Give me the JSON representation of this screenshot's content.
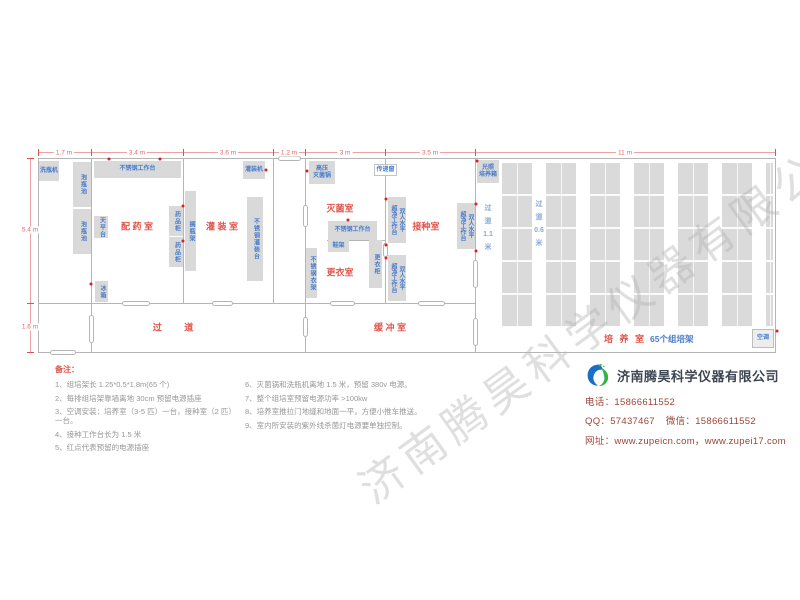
{
  "watermark": "济南腾昊科学仪器有限公司",
  "plan": {
    "rooms": [
      {
        "name": "prep-room",
        "label": "配 药 室",
        "x": 137,
        "y": 226
      },
      {
        "name": "filling-room",
        "label": "灌 装 室",
        "x": 222,
        "y": 226
      },
      {
        "name": "sterilization-room",
        "label": "灭菌室",
        "x": 340,
        "y": 208
      },
      {
        "name": "dressing-room",
        "label": "更衣室",
        "x": 340,
        "y": 272
      },
      {
        "name": "inoculation-room",
        "label": "接种室",
        "x": 426,
        "y": 226
      },
      {
        "name": "corridor",
        "label": "过    道",
        "x": 178,
        "y": 327,
        "ls": 10
      },
      {
        "name": "buffer-room",
        "label": "缓 冲 室",
        "x": 390,
        "y": 327
      }
    ],
    "culture_room": {
      "red_label": "培 养 室",
      "blue_label": "65个组培架"
    },
    "aisles": [
      {
        "name": "aisle-1-1m",
        "lines": [
          "过",
          "道",
          "1.1",
          "米"
        ],
        "x": 488,
        "y": 228
      },
      {
        "name": "aisle-0-6m",
        "lines": [
          "过",
          "道",
          "0.6",
          "米"
        ],
        "x": 539,
        "y": 224
      }
    ],
    "equipment": [
      {
        "name": "bottle-washer",
        "label": "洗瓶机",
        "x": 39,
        "y": 161,
        "w": 20,
        "h": 20,
        "mode": "h"
      },
      {
        "name": "soak-pool-1",
        "label": "泡瓶池",
        "x": 73,
        "y": 162,
        "w": 18,
        "h": 45,
        "mode": "v"
      },
      {
        "name": "soak-pool-2",
        "label": "泡瓶池",
        "x": 73,
        "y": 209,
        "w": 18,
        "h": 45,
        "mode": "v"
      },
      {
        "name": "ss-workbench-prep",
        "label": "不锈钢工作台",
        "x": 94,
        "y": 161,
        "w": 87,
        "h": 17,
        "mode": "h"
      },
      {
        "name": "balance-table",
        "label": "天平台",
        "x": 94,
        "y": 216,
        "w": 14,
        "h": 22,
        "mode": "v"
      },
      {
        "name": "medicine-cabinet-1",
        "label": "药品柜",
        "x": 169,
        "y": 206,
        "w": 14,
        "h": 30,
        "mode": "v"
      },
      {
        "name": "medicine-cabinet-2",
        "label": "药品柜",
        "x": 169,
        "y": 237,
        "w": 14,
        "h": 30,
        "mode": "v"
      },
      {
        "name": "bottle-shelf-rack",
        "label": "搁瓶架",
        "x": 185,
        "y": 191,
        "w": 11,
        "h": 80,
        "mode": "v"
      },
      {
        "name": "fridge",
        "label": "冰箱",
        "x": 95,
        "y": 281,
        "w": 13,
        "h": 21,
        "mode": "v"
      },
      {
        "name": "filling-machine",
        "label": "灌装机",
        "x": 243,
        "y": 161,
        "w": 22,
        "h": 18,
        "mode": "h"
      },
      {
        "name": "ss-filling-table",
        "label": "不锈钢灌装台",
        "x": 247,
        "y": 197,
        "w": 16,
        "h": 84,
        "mode": "v"
      },
      {
        "name": "autoclave",
        "label": "高压\n灭菌锅",
        "x": 309,
        "y": 161,
        "w": 26,
        "h": 23,
        "mode": "h"
      },
      {
        "name": "pass-through-window",
        "label": "传递窗",
        "x": 374,
        "y": 164,
        "w": 23,
        "h": 12,
        "mode": "h",
        "light": true
      },
      {
        "name": "ss-workbench-steril",
        "label": "不锈钢工作台",
        "x": 328,
        "y": 221,
        "w": 49,
        "h": 19,
        "mode": "h"
      },
      {
        "name": "shoe-rack",
        "label": "鞋架",
        "x": 328,
        "y": 240,
        "w": 21,
        "h": 12,
        "mode": "h"
      },
      {
        "name": "locker",
        "label": "更衣柜",
        "x": 369,
        "y": 240,
        "w": 13,
        "h": 48,
        "mode": "v"
      },
      {
        "name": "ss-clothes-rack",
        "label": "不锈钢衣架",
        "x": 306,
        "y": 248,
        "w": 11,
        "h": 50,
        "mode": "v"
      },
      {
        "name": "clean-bench-1",
        "label": "双人水平\n超净工作台",
        "x": 388,
        "y": 197,
        "w": 18,
        "h": 46,
        "mode": "v2"
      },
      {
        "name": "clean-bench-2",
        "label": "双人水平\n超净工作台",
        "x": 388,
        "y": 255,
        "w": 18,
        "h": 46,
        "mode": "v2"
      },
      {
        "name": "clean-bench-3",
        "label": "双人水平\n超净工作台",
        "x": 457,
        "y": 203,
        "w": 18,
        "h": 46,
        "mode": "v2"
      },
      {
        "name": "light-incubator",
        "label": "光照\n培养箱",
        "x": 477,
        "y": 160,
        "w": 22,
        "h": 23,
        "mode": "h"
      },
      {
        "name": "air-conditioner",
        "label": "空调",
        "x": 752,
        "y": 329,
        "w": 22,
        "h": 19,
        "mode": "h",
        "light2": true
      }
    ],
    "dimensions": {
      "top": [
        {
          "label": "1.7 m",
          "cx": 64
        },
        {
          "label": "3.4 m",
          "cx": 137
        },
        {
          "label": "3.6 m",
          "cx": 228
        },
        {
          "label": "1.2 m",
          "cx": 289
        },
        {
          "label": "3 m",
          "cx": 345
        },
        {
          "label": "3.5 m",
          "cx": 430
        },
        {
          "label": "11 m",
          "cx": 625
        }
      ],
      "left": [
        {
          "label": "5.4 m",
          "cy": 230
        },
        {
          "label": "1.6 m",
          "cy": 327
        }
      ]
    }
  },
  "notes": {
    "title": "备注：",
    "col1": [
      "1、组培架长 1.25*0.5*1.8m(65 个)",
      "2、每排组培架靠墙离地 30cm 预留电源插座",
      "3、空调安装：培养室（3-5 匹）一台，接种室（2 匹）一台。",
      "4、接种工作台长为 1.5 米",
      "5、红点代表预留的电源插座"
    ],
    "col2": [
      "6、灭菌锅和洗瓶机离地 1.5 米，预留 380v 电源。",
      "7、整个组培室预留电源功率 >100kw",
      "8、培养室推拉门地缝和地面一平，方便小推车推送。",
      "9、室内所安装的紫外线杀菌灯电源要单独控制。"
    ]
  },
  "company": {
    "name": "济南腾昊科学仪器有限公司",
    "phone_label": "电话：",
    "phone": "15866611552",
    "qq_label": "QQ：",
    "qq": "57437467",
    "wechat_label": "微信：",
    "wechat": "15866611552",
    "web_label": "网址：",
    "web": "www.zupeicn.com，www.zupei17.com"
  },
  "colors": {
    "accent_red": "#e0544a",
    "label_blue": "#4a7cc9",
    "corridor_blue": "#85a9da",
    "block_grey": "#d9d9d9",
    "wall_grey": "#b5b5b5",
    "dim_pink": "#eda3a3",
    "note_grey": "#979797",
    "company_text": "#9c4538"
  },
  "layout": {
    "walls": [
      [
        38,
        158,
        737,
        1
      ],
      [
        38,
        352,
        738,
        1
      ],
      [
        38,
        158,
        1,
        195
      ],
      [
        775,
        158,
        1,
        195
      ],
      [
        91,
        158,
        1,
        145
      ],
      [
        91,
        303,
        1,
        49
      ],
      [
        183,
        158,
        1,
        145
      ],
      [
        273,
        158,
        1,
        145
      ],
      [
        305,
        158,
        1,
        194
      ],
      [
        385,
        158,
        1,
        145
      ],
      [
        475,
        158,
        1,
        194
      ],
      [
        38,
        303,
        438,
        1
      ],
      [
        327,
        240,
        59,
        1
      ]
    ],
    "doors": [
      {
        "o": "h",
        "x": 278,
        "y": 158,
        "len": 23
      },
      {
        "o": "h",
        "x": 122,
        "y": 303,
        "len": 28
      },
      {
        "o": "h",
        "x": 212,
        "y": 303,
        "len": 21
      },
      {
        "o": "h",
        "x": 330,
        "y": 303,
        "len": 25
      },
      {
        "o": "h",
        "x": 418,
        "y": 303,
        "len": 27
      },
      {
        "o": "h",
        "x": 50,
        "y": 352,
        "len": 26
      },
      {
        "o": "v",
        "x": 91,
        "y": 315,
        "len": 28
      },
      {
        "o": "v",
        "x": 305,
        "y": 205,
        "len": 22
      },
      {
        "o": "v",
        "x": 305,
        "y": 317,
        "len": 20
      },
      {
        "o": "v",
        "x": 385,
        "y": 243,
        "len": 14
      },
      {
        "o": "v",
        "x": 475,
        "y": 260,
        "len": 28
      },
      {
        "o": "v",
        "x": 475,
        "y": 318,
        "len": 28
      }
    ],
    "racks": {
      "x_start": 502,
      "spacing": 44,
      "width": 30,
      "count": 7,
      "y": 163,
      "height": 164,
      "clip_right": 773
    },
    "dim_top": {
      "y": 152,
      "x1": 38,
      "x2": 775,
      "ticks": [
        38,
        91,
        183,
        273,
        305,
        385,
        475,
        775
      ]
    },
    "dim_left": {
      "x": 30,
      "y1": 158,
      "y2": 352,
      "ticks": [
        158,
        303,
        352
      ]
    },
    "sockets": [
      [
        109,
        159
      ],
      [
        160,
        159
      ],
      [
        266,
        170
      ],
      [
        183,
        206
      ],
      [
        183,
        241
      ],
      [
        91,
        284
      ],
      [
        307,
        171
      ],
      [
        348,
        220
      ],
      [
        386,
        199
      ],
      [
        386,
        245
      ],
      [
        386,
        258
      ],
      [
        476,
        204
      ],
      [
        476,
        251
      ],
      [
        477,
        161
      ],
      [
        777,
        331
      ]
    ]
  }
}
